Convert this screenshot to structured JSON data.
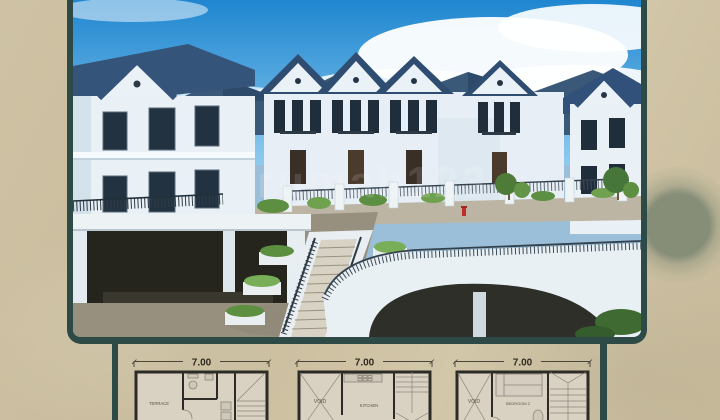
{
  "meta": {
    "kind": "real-estate-flyer-screenshot",
    "background_color": "#cdc0a3",
    "frame_color": "#2e4a46"
  },
  "photo": {
    "alt": "Aerial view of a white two-storey housing cluster with dark blue gable roofs, central landscaped staircase with planters, and a curved white bridge over a driveway",
    "watermark": "rumah123",
    "colors": {
      "sky": "#2f8fd8",
      "roof": "#35547a",
      "walls": "#e9f0f6",
      "greenery": "#5d8f43",
      "pavement": "#97907f"
    }
  },
  "floorplans": [
    {
      "dimension": "7.00",
      "rooms": [
        "TERRACE"
      ]
    },
    {
      "dimension": "7.00",
      "rooms": [
        "VOID",
        "KITCHEN"
      ]
    },
    {
      "dimension": "7.00",
      "rooms": [
        "VOID",
        "BEDROOM 2"
      ]
    }
  ]
}
